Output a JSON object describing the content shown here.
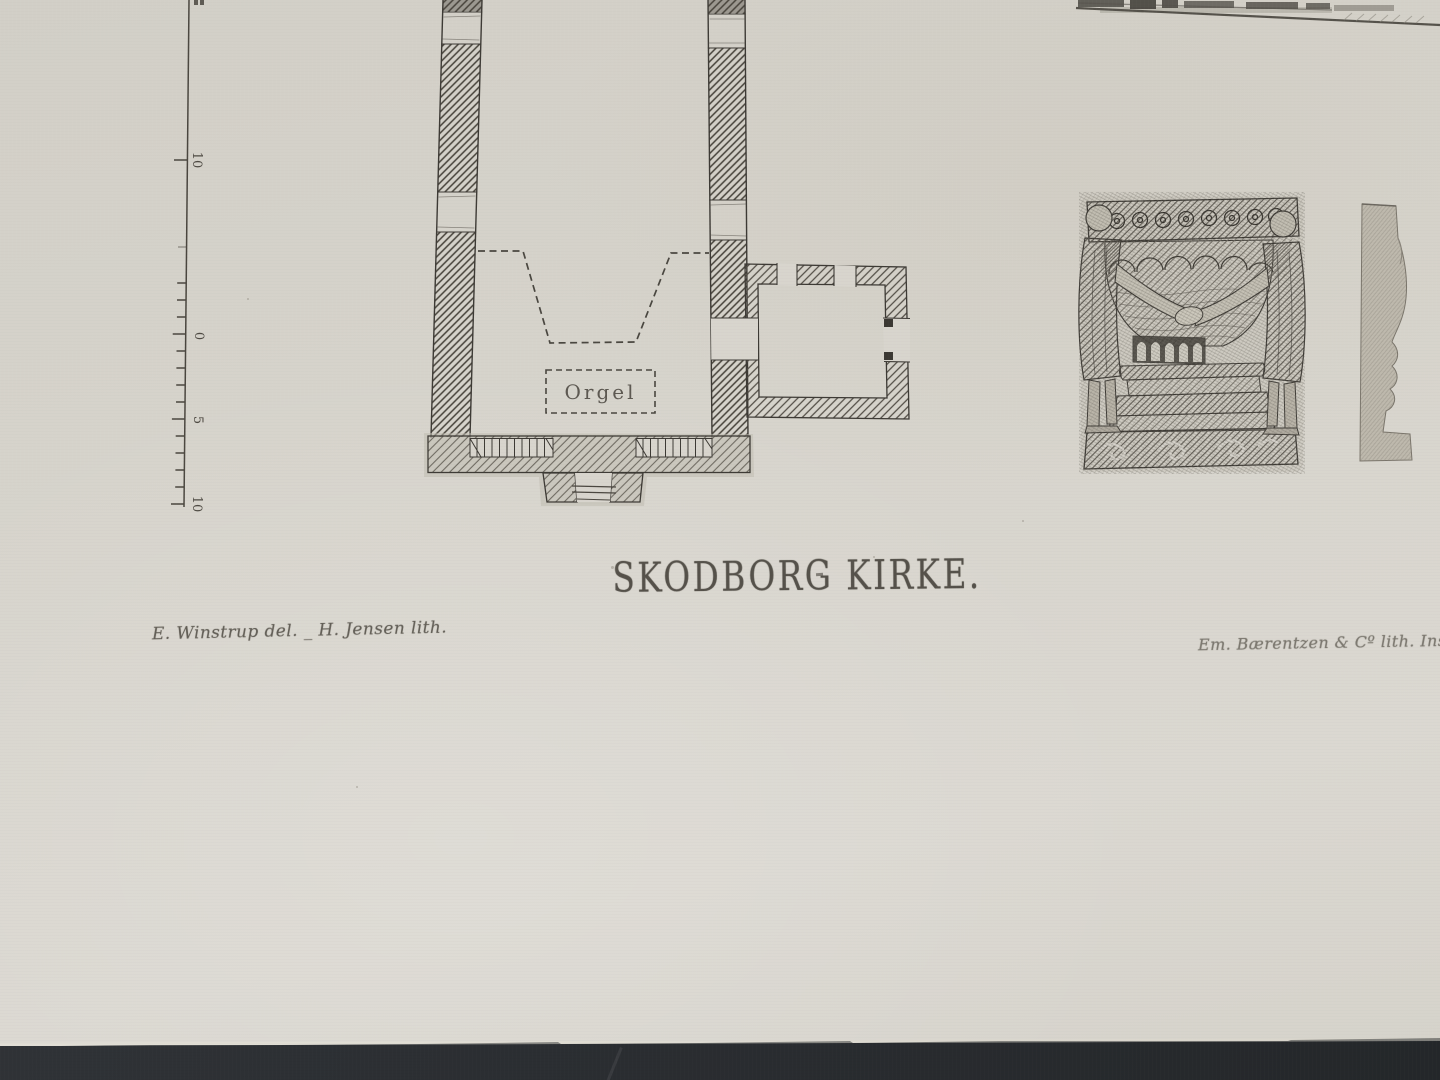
{
  "photo": {
    "paper_color": "#d7d4cc",
    "surface_color": "#2b2e32",
    "ink_color": "#47443d"
  },
  "plate": {
    "title": "SKODBORG KIRKE.",
    "credit_left": "E. Winstrup del. _ H. Jensen lith.",
    "credit_right": "Em. Bærentzen & Cº lith. Inst.",
    "plan": {
      "orgel_label": "Orgel"
    },
    "scale_bar": {
      "labels": [
        "10",
        "0",
        "5",
        "10"
      ]
    }
  }
}
